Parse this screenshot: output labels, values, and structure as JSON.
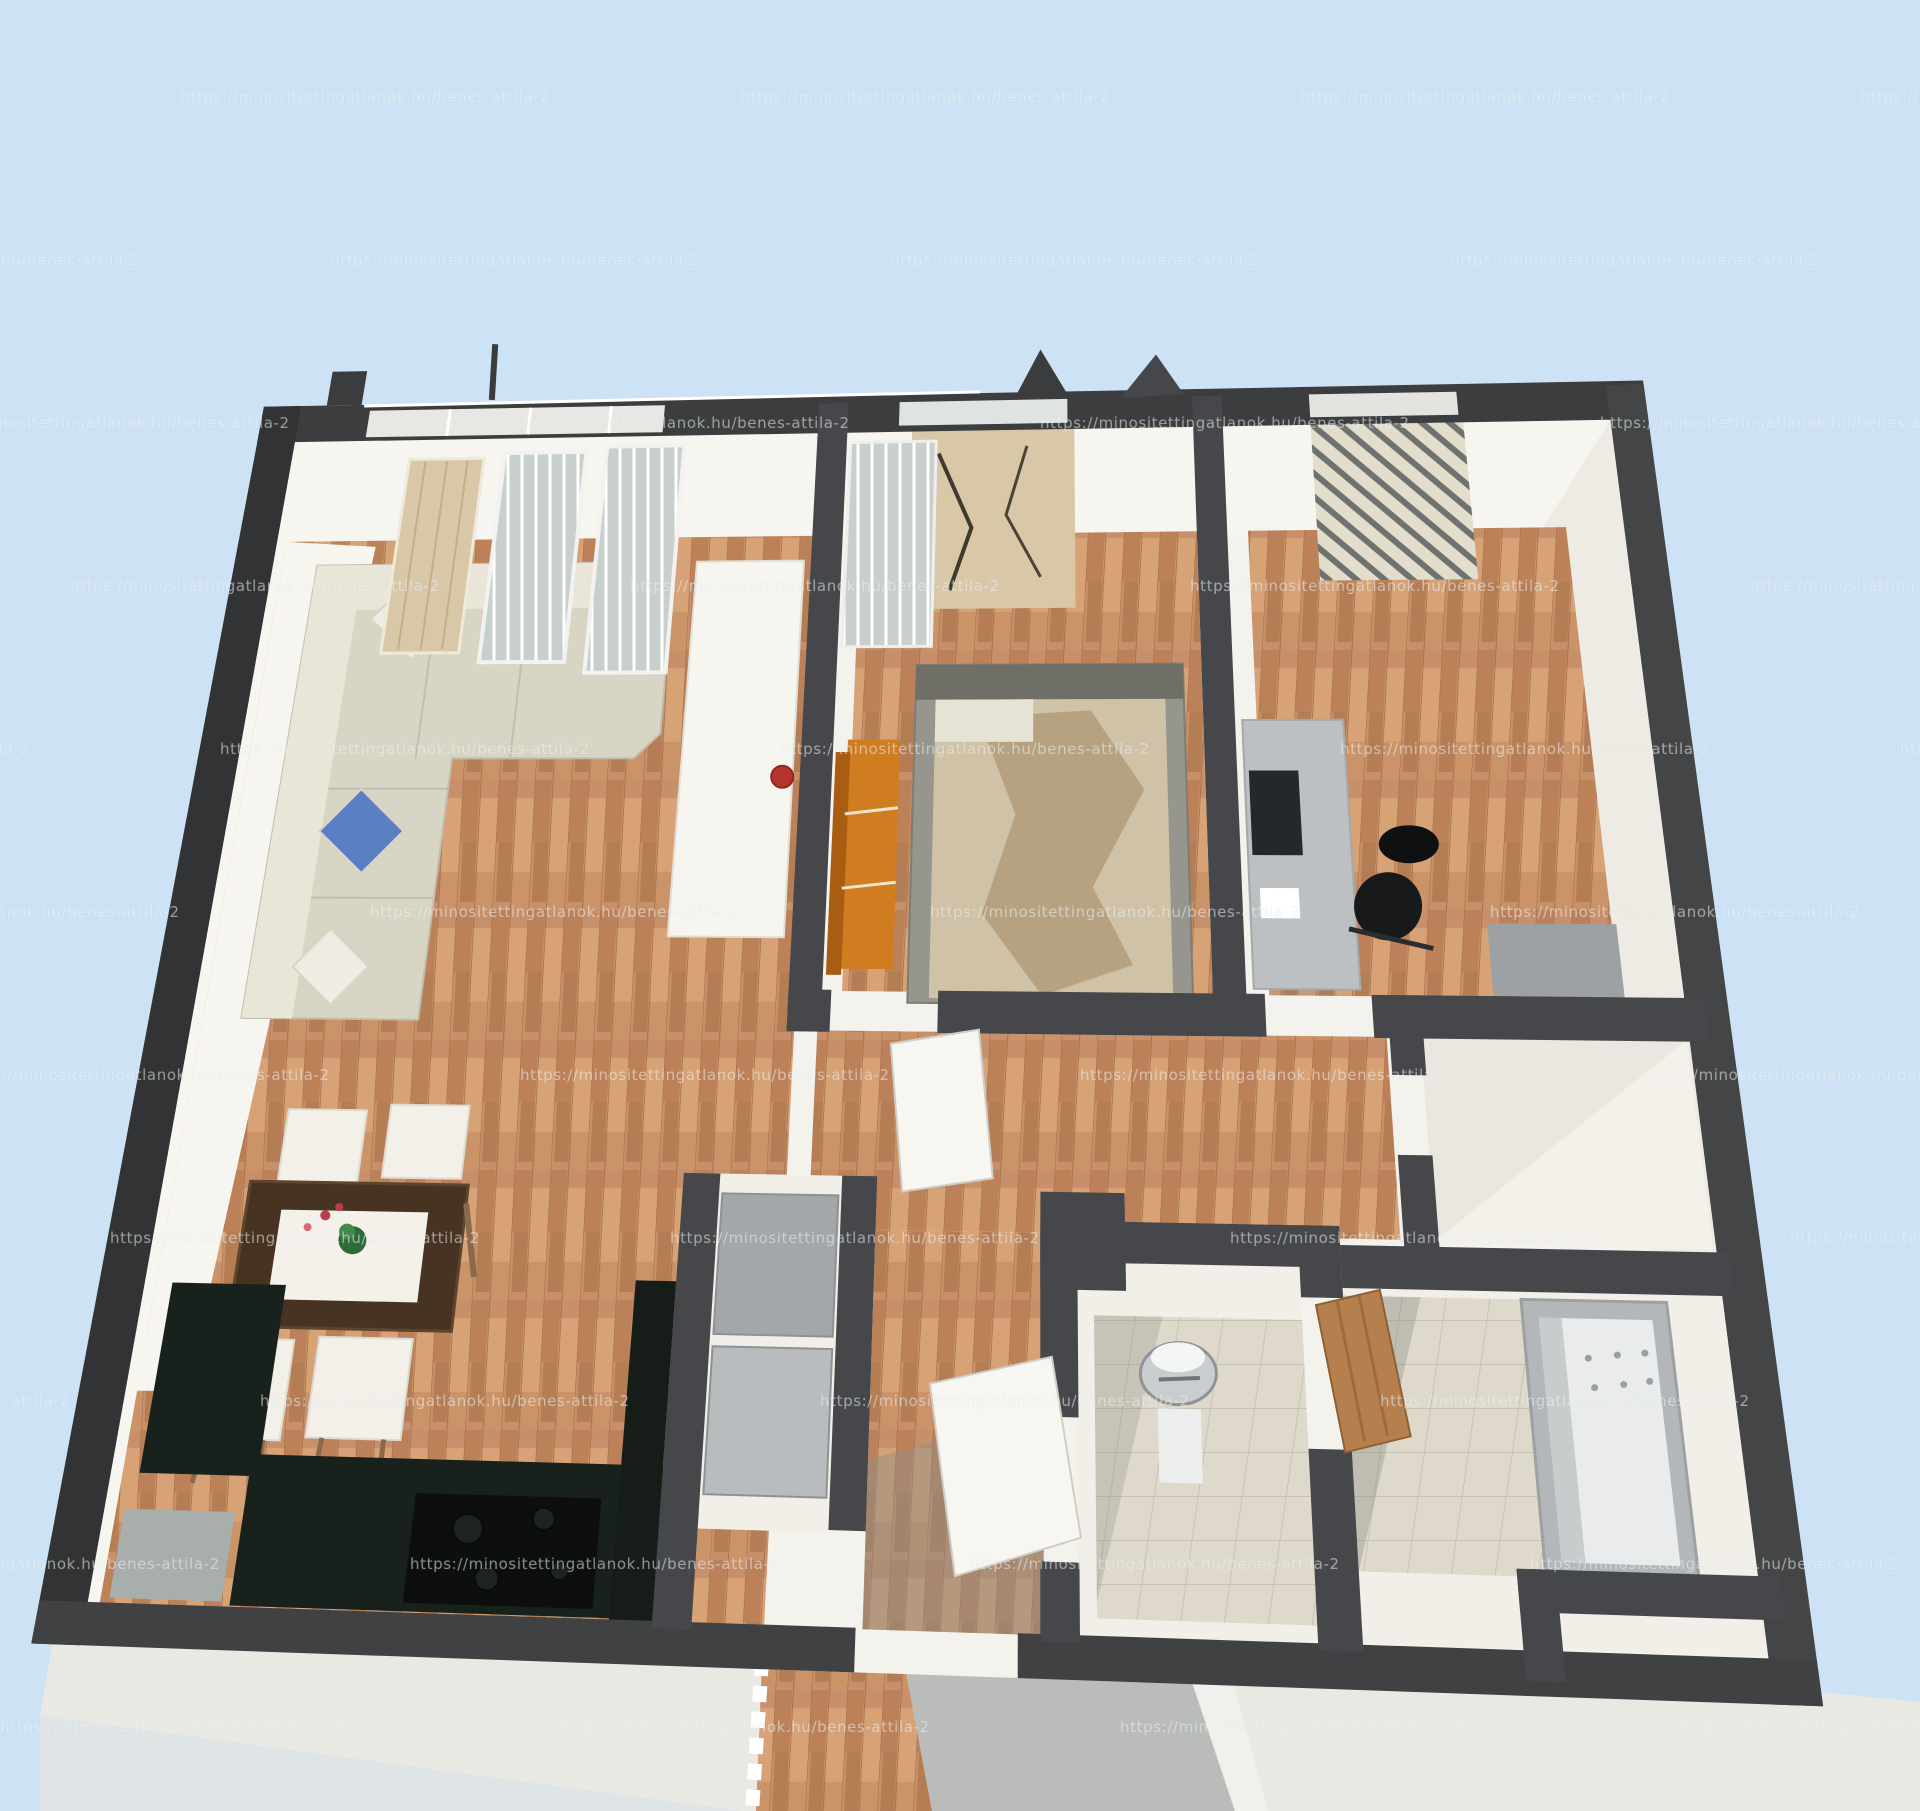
{
  "watermark": {
    "text": "https://minositettingatlanok.hu/benes-attila-2"
  },
  "palette": {
    "sky": "#cde2f5",
    "base_white": "#f4f2ec",
    "wall_dark": "#3b3d3e",
    "wall_inner": "#45474a",
    "wall_face_white": "#f7f5ef",
    "wall_face_shade": "#e9e7df",
    "wood_floor": "#c8906a",
    "wood_streak_dark": "#b57d54",
    "wood_streak_light": "#d6a276",
    "tile_floor": "#ded9ca",
    "tile_grid": "#c7c2b1",
    "sofa": "#d9d5c5",
    "sofa_light": "#e9e5d7",
    "pillow_white": "#efede3",
    "pillow_blue": "#5b7fc4",
    "dining_table": "#463321",
    "table_runner": "#f3f1e9",
    "plant_green": "#2e6b38",
    "flower_red": "#c23b4a",
    "chair_white": "#f2f0e8",
    "chair_leg": "#8a6a4a",
    "kitchen_counter": "#18211c",
    "cooktop_black": "#0c0f0e",
    "fridge_gray_a": "#a3a7a9",
    "fridge_gray_b": "#b8bcbe",
    "cabinet_black": "#161d18",
    "doormat_gray": "#a8aeac",
    "bed_frame": "#96968f",
    "mattress": "#cfc2a6",
    "blanket": "#b4a07e",
    "shelf_orange": "#d07c20",
    "shelf_orange_dark": "#a85d12",
    "desk_gray": "#bcc0c2",
    "monitor_dark": "#25282b",
    "office_chair_black": "#17191b",
    "tub_outer": "#b3b7b9",
    "tub_inner": "#e9ebec",
    "basin_gray": "#c9cdcf",
    "door_white": "#f8f6f1",
    "door_wood": "#b5804e",
    "glass_pane": "#c7d0cd",
    "tree_tan": "#d9c8a8",
    "apron_gray": "#e9e9e4",
    "walkway_gray": "#b9bcb8"
  }
}
